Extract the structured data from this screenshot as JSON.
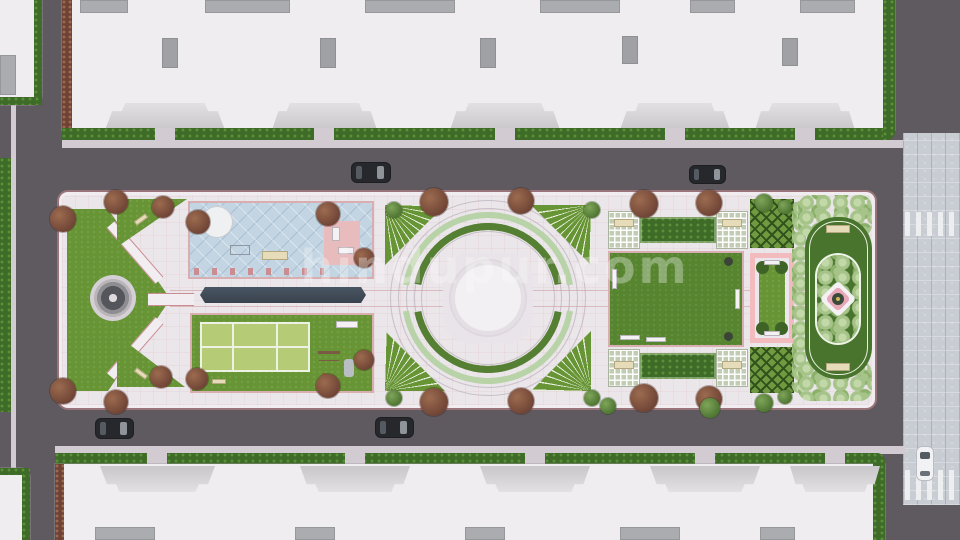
{
  "watermark": {
    "text": "hindupur.com"
  },
  "palette": {
    "road": "#5f5960",
    "pave": "#ebe6ea",
    "paveBright": "#f1edf1",
    "pink": "#d9aeb0",
    "pinkDeep": "#c98d92",
    "pinkGarden": "#f2bcbe",
    "lawn": "#679434",
    "lawnDark": "#56842f",
    "court": "#b5cb76",
    "courtLine": "#eef2e4",
    "hedge": "#3f6b28",
    "hedgeDot": "#5b8f3a",
    "bush1": "#a6c489",
    "bush2": "#c2d8a8",
    "bush3": "#8ab06a",
    "pool": "#c3d5e3",
    "poolDark": "#414c5a",
    "water": "#55565c",
    "roof": "#efedef",
    "roofGray": "#aaacaf",
    "canopy": "#d9d7d9",
    "curb": "#d2ccd2",
    "paver": "#c8ccd3",
    "treeM1": "#6e4335",
    "treeM2": "#9c6b4f",
    "treeG1": "#4c7330",
    "treeG2": "#7fa55a",
    "bench": "#e6dcba",
    "carDark": "#26282c",
    "glass": "#8f949b",
    "white": "#f2f2f4",
    "arcLight": "#b9d3a8",
    "arcDark": "#557f33"
  },
  "scene": {
    "description": "Aerial top-down 3D architectural render of a long landscaped courtyard between two apartment blocks",
    "buildings": [
      "north apartment block",
      "south apartment block",
      "north-west corner block",
      "south-west corner block"
    ],
    "roads": [
      "north road",
      "south road",
      "west road",
      "east paved walkway with two zebra crossings"
    ],
    "park_features": [
      "chevron lawn with circular fountain",
      "two triangular lawns with benches",
      "blue tiled water plaza with kiosk and pink deck",
      "dark linear reflecting pool",
      "sports lawn with marked court",
      "children playground",
      "notice sign",
      "circular amphitheater plaza with double green arcs and four fan planters",
      "two lawn panels framed by pergola seating",
      "pink-framed formal garden",
      "two knot-pattern parterre beds",
      "oval garden with shrub ring and flower medallion",
      "fluffy shrub borders",
      "maroon and green street trees"
    ],
    "vehicles": [
      {
        "name": "dark-car-1",
        "location": "north road, left"
      },
      {
        "name": "dark-car-2",
        "location": "north road, right"
      },
      {
        "name": "dark-car-3",
        "location": "south road, left"
      },
      {
        "name": "dark-car-4",
        "location": "south road, center"
      },
      {
        "name": "white-car",
        "location": "east walkway crossing"
      }
    ]
  }
}
